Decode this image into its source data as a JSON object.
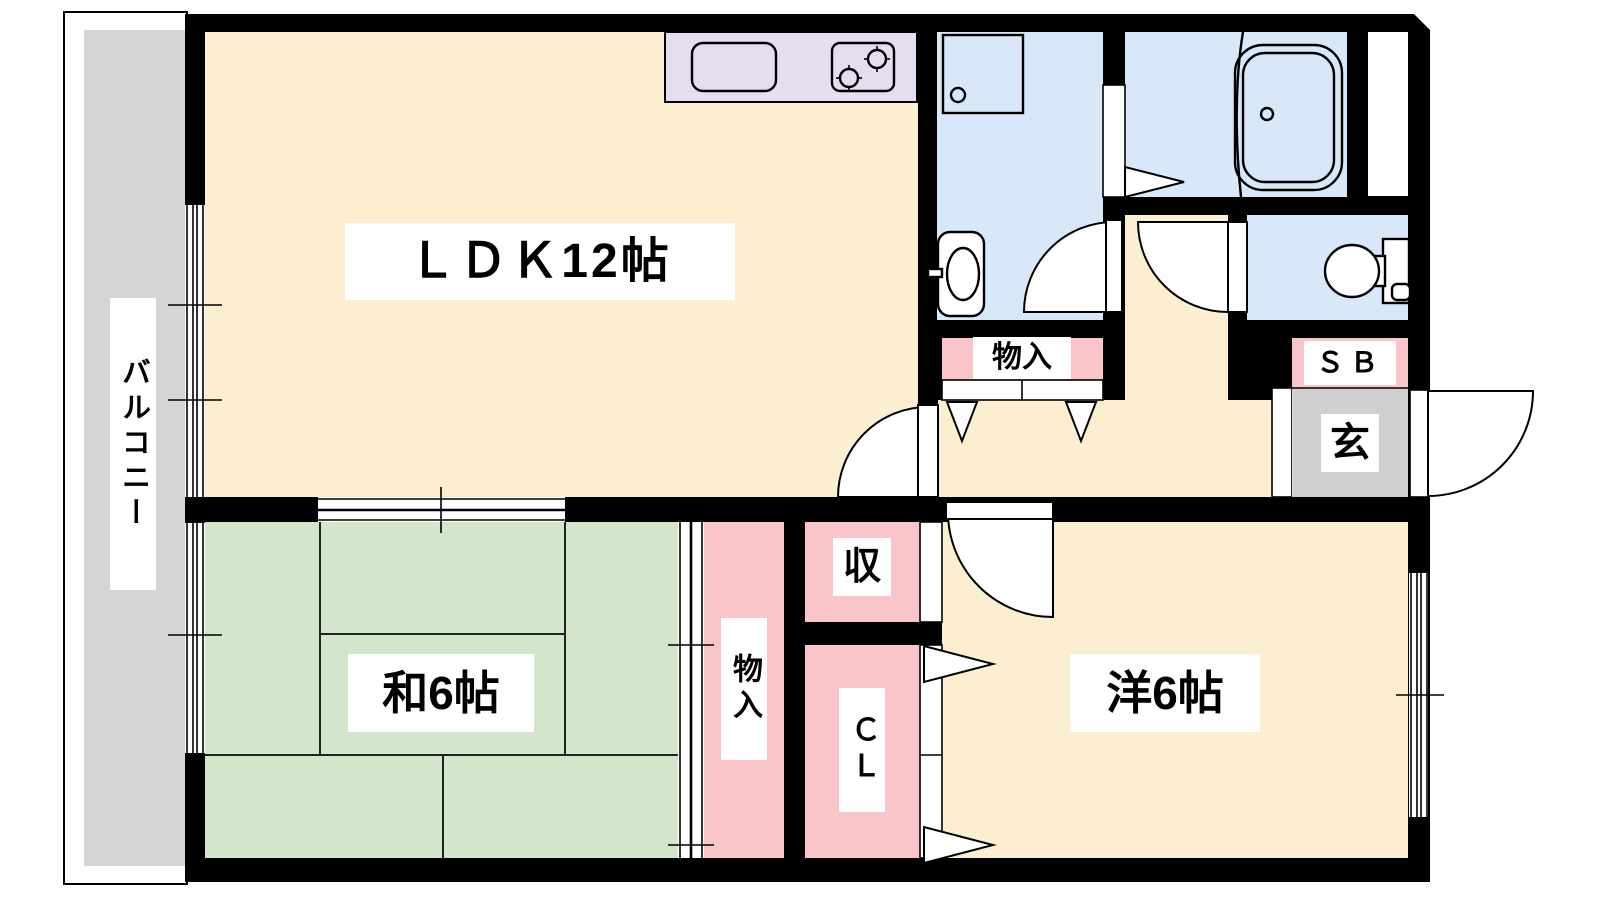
{
  "plan": {
    "type": "apartment-floor-plan",
    "layout_name": "2DK",
    "labels": {
      "ldk": "ＬＤＫ12帖",
      "japanese_room": "和6帖",
      "western_room": "洋6帖",
      "balcony": "バルコニー",
      "entrance": "玄",
      "hall_storage": "物入",
      "tatami_storage": "物入",
      "storage_short": "収",
      "closet": "ＣＬ",
      "shoe_box": "ＳＢ"
    },
    "colors": {
      "room_cream": "#FBEED1",
      "tatami_green": "#D3E5CA",
      "water_blue": "#D8E8F8",
      "storage_pink": "#F9C5C8",
      "kitchen_lavender": "#E6DDF1",
      "balcony_gray": "#D5D5D5",
      "entrance_gray": "#CFCFCF",
      "wall_black": "#000000"
    }
  }
}
